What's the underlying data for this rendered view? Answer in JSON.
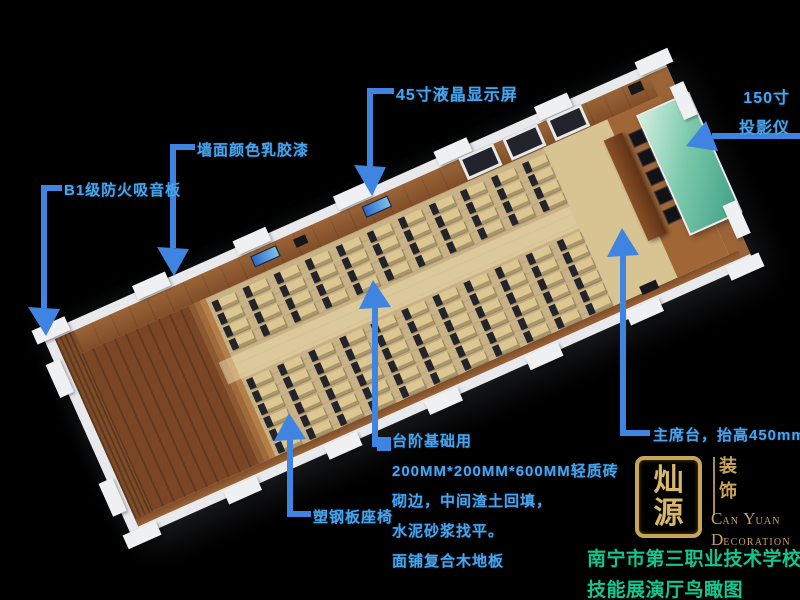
{
  "annotations": {
    "lcd_screen": {
      "label": "45寸液晶显示屏"
    },
    "projector": {
      "line1": "150寸",
      "line2": "投影仪"
    },
    "wall_paint": {
      "label": "墙面颜色乳胶漆"
    },
    "acoustic_panel": {
      "label": "B1级防火吸音板"
    },
    "seat": {
      "label": "塑钢板座椅"
    },
    "stage": {
      "label": "主席台，抬高450mm"
    },
    "steps_note": {
      "lines": [
        "台阶基础用",
        "200MM*200MM*600MM轻质砖",
        "砌边，中间渣土回填，",
        "水泥砂浆找平。",
        "面铺复合木地板"
      ]
    }
  },
  "logo": {
    "seal_top": "灿",
    "seal_bottom": "源",
    "side_top": "装",
    "side_bottom": "饰",
    "en1_a": "C",
    "en1_b": "AN",
    "en1_c": "Y",
    "en1_d": "UAN",
    "en2_a": "D",
    "en2_b": "ECORATION"
  },
  "caption": {
    "line1": "南宁市第三职业技术学校",
    "line2": "技能展演厅鸟瞰图"
  },
  "colors": {
    "label_blue": "#4aa4ea",
    "arrow_blue": "#3e84e0",
    "caption_green": "#12c78f",
    "logo_gold": "#c9a558"
  },
  "scene": {
    "desk_rows": 11,
    "upper_units_per_row": 4,
    "lower_units_per_row": 6,
    "vip_chair_count": 5,
    "window_count": 3,
    "wall_screen_count": 2,
    "colors": {
      "floor": "#c9b285",
      "desk": "#dcc792",
      "chair": "#23232b",
      "wall": "#9a6437",
      "wall_dark": "#7e4c28",
      "platform": "#7a4626",
      "stage": "#a06636",
      "table": "#5f3318",
      "screen_green": "#7cc9ad"
    }
  }
}
